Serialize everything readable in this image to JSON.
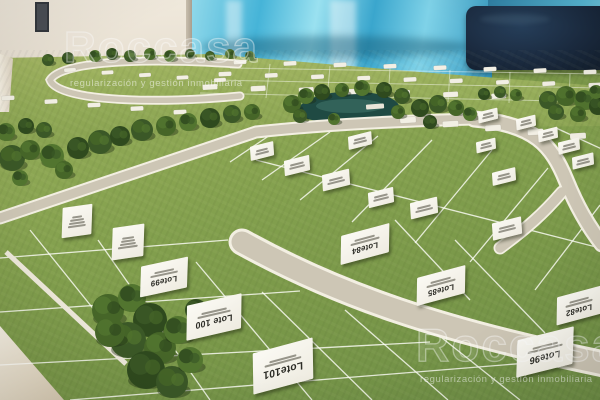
{
  "watermark": {
    "logo": "Roccasa",
    "tagline": "regularización y gestión inmobiliaria"
  },
  "lot_signs": [
    {
      "id": "lote84",
      "label": "Lote84"
    },
    {
      "id": "lote85",
      "label": "Lote85"
    },
    {
      "id": "lote82",
      "label": "Lote82"
    },
    {
      "id": "lote96",
      "label": "Lote96"
    },
    {
      "id": "lote99",
      "label": "Lote99"
    },
    {
      "id": "lote100",
      "label": "Lote 100"
    },
    {
      "id": "lote101",
      "label": "Lote101"
    }
  ]
}
